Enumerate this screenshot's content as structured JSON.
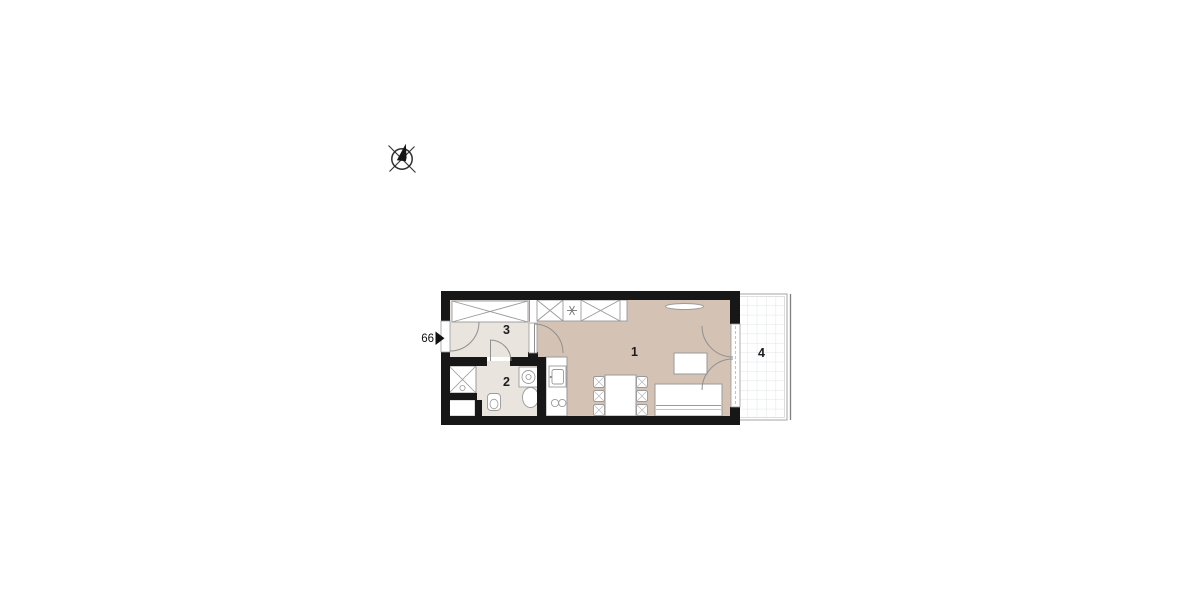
{
  "title": "apartment-floor-plan",
  "entrance": {
    "unit_number": "66",
    "arrow_icon": "right-arrow-icon"
  },
  "compass": {
    "icon": "compass-north-icon"
  },
  "rooms": [
    {
      "id": "living-kitchen",
      "label": "1"
    },
    {
      "id": "bathroom",
      "label": "2"
    },
    {
      "id": "hallway",
      "label": "3"
    },
    {
      "id": "balcony",
      "label": "4"
    }
  ],
  "colors": {
    "wall": "#171717",
    "living_floor": "#d4c3b4",
    "service_floor": "#e9e4de",
    "furniture_outline": "#9a9a9a",
    "balcony_grid": "#e0e4e7",
    "balcony_frame": "#b3b3b3"
  }
}
